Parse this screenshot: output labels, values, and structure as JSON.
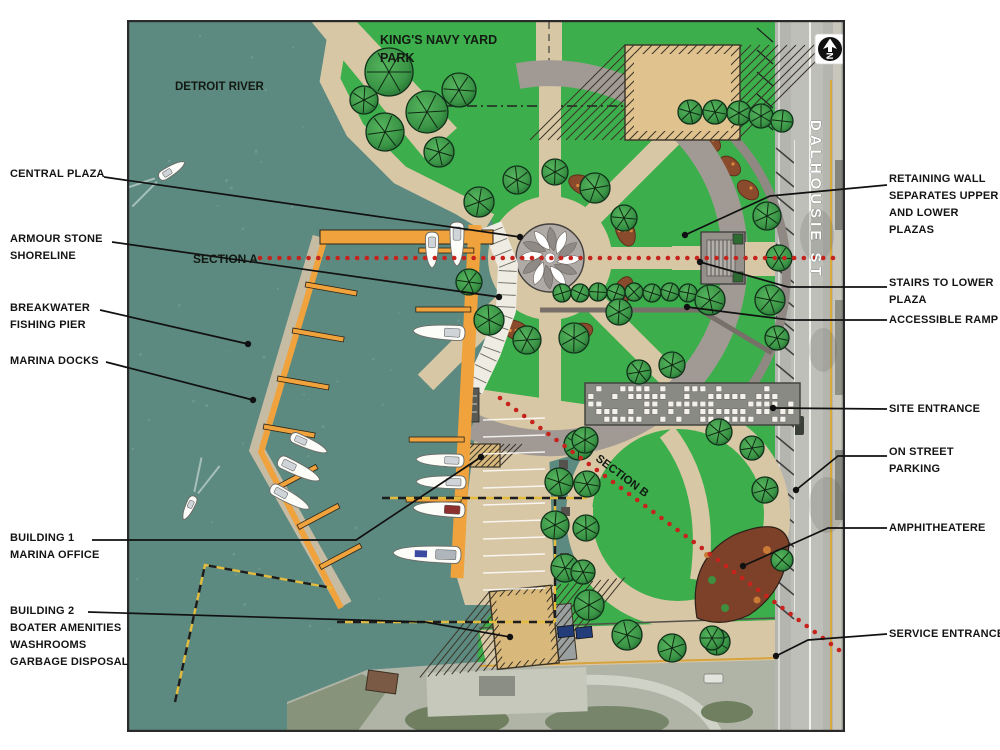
{
  "map": {
    "labels": {
      "detroit_river": "DETROIT RIVER",
      "park_line1": "KING'S NAVY YARD",
      "park_line2": "PARK",
      "section_a": "SECTION A",
      "section_b": "SECTION B",
      "street": "DALHOUSIE ST",
      "north": "N"
    },
    "colors": {
      "water": "#5d8a80",
      "park_green": "#3cae4b",
      "path_tan": "#d8c7a5",
      "plaza_gray": "#a19a94",
      "dock_orange": "#f0a23c",
      "section_line_red": "#c6231d",
      "property_line_yellow": "#e3bc3e",
      "armour_white": "#efece3",
      "road_gray": "#b5b5b0"
    }
  },
  "annotations": {
    "left": [
      {
        "id": "central-plaza",
        "lines": [
          "CENTRAL PLAZA"
        ]
      },
      {
        "id": "armour-stone-shoreline",
        "lines": [
          "ARMOUR STONE",
          "SHORELINE"
        ]
      },
      {
        "id": "breakwater-fishing-pier",
        "lines": [
          "BREAKWATER",
          "FISHING PIER"
        ]
      },
      {
        "id": "marina-docks",
        "lines": [
          "MARINA DOCKS"
        ]
      },
      {
        "id": "building-1",
        "lines": [
          "BUILDING 1",
          "MARINA OFFICE"
        ]
      },
      {
        "id": "building-2",
        "lines": [
          "BUILDING 2",
          "BOATER AMENITIES",
          "WASHROOMS",
          "GARBAGE DISPOSAL"
        ]
      }
    ],
    "right": [
      {
        "id": "retaining-wall",
        "lines": [
          "RETAINING WALL",
          "SEPARATES UPPER",
          "AND LOWER",
          "PLAZAS"
        ]
      },
      {
        "id": "stairs-to-lower-plaza",
        "lines": [
          "STAIRS TO LOWER",
          "PLAZA"
        ]
      },
      {
        "id": "accessible-ramp",
        "lines": [
          "ACCESSIBLE RAMP"
        ]
      },
      {
        "id": "site-entrance",
        "lines": [
          "SITE ENTRANCE"
        ]
      },
      {
        "id": "on-street-parking",
        "lines": [
          "ON STREET",
          "PARKING"
        ]
      },
      {
        "id": "amphitheatere",
        "lines": [
          "AMPHITHEATERE"
        ]
      },
      {
        "id": "service-entrance",
        "lines": [
          "SERVICE ENTRANCE"
        ]
      }
    ]
  }
}
